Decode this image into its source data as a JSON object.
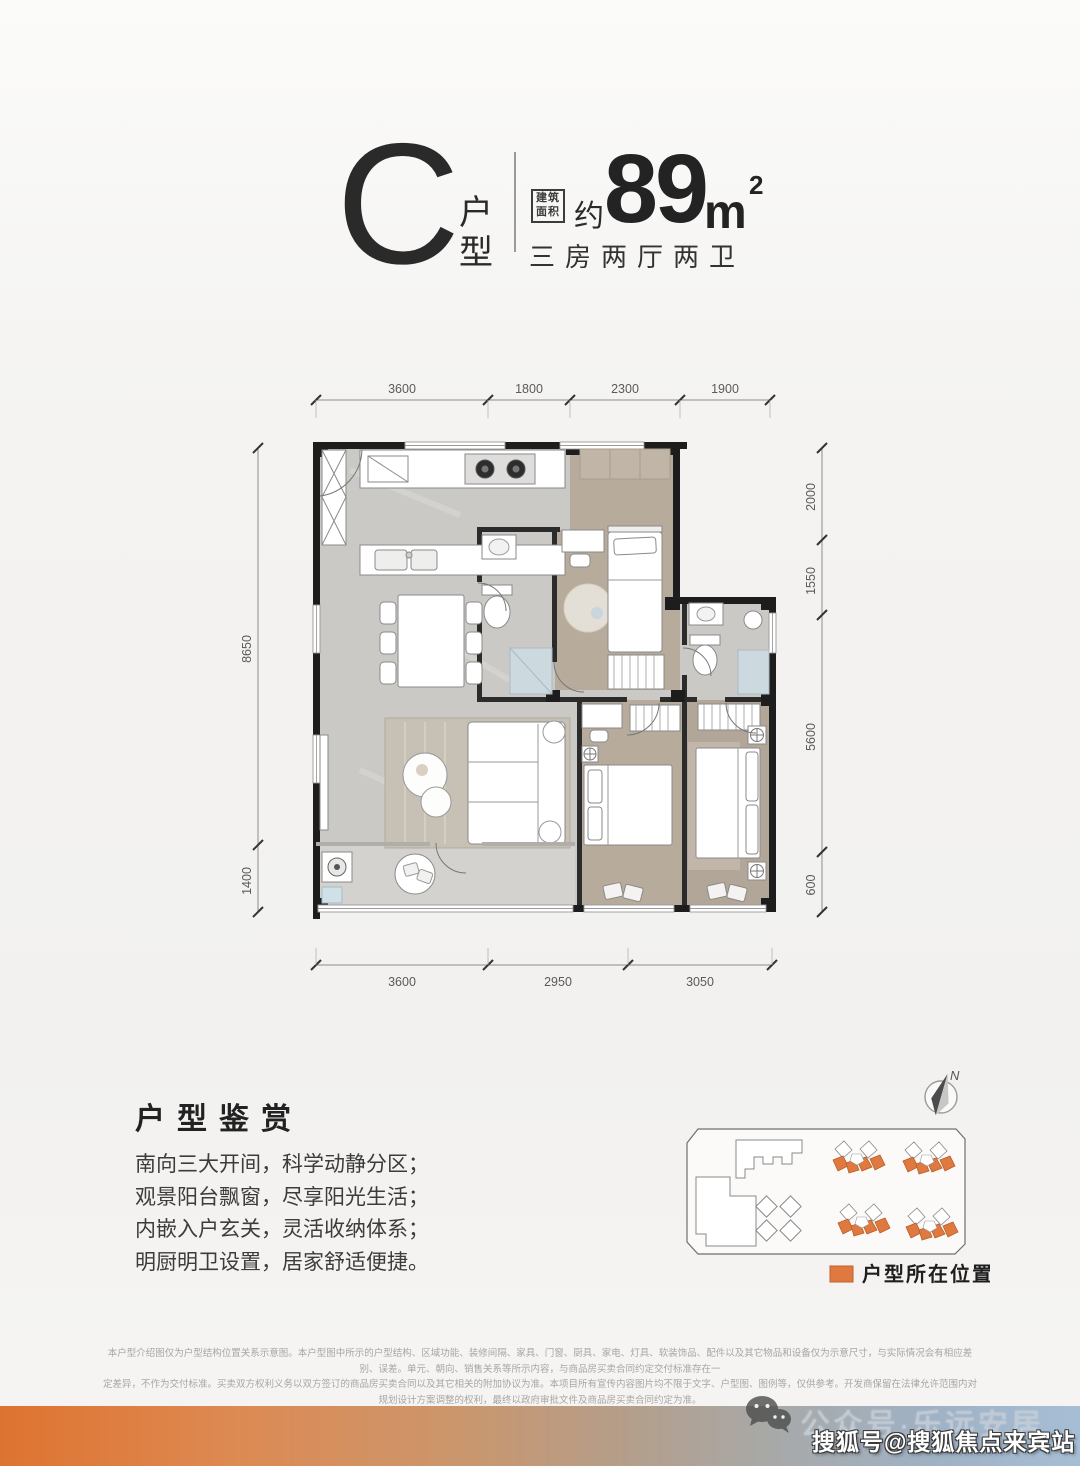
{
  "header": {
    "unit_letter": "C",
    "unit_type_char1": "户",
    "unit_type_char2": "型",
    "stamp_line1": "建筑",
    "stamp_line2": "面积",
    "approx": "约",
    "area_value": "89",
    "area_unit": "m",
    "area_sup": "2",
    "rooms": "三房两厅两卫"
  },
  "floorplan": {
    "dims_top": [
      "3600",
      "1800",
      "2300",
      "1900"
    ],
    "dims_bottom": [
      "3600",
      "2950",
      "3050"
    ],
    "dims_left": [
      "8650",
      "1400"
    ],
    "dims_right": [
      "2000",
      "1550",
      "5600",
      "600"
    ]
  },
  "appreciation": {
    "title": "户型鉴赏",
    "line1": "南向三大开间，科学动静分区；",
    "line2": "观景阳台飘窗，尽享阳光生活；",
    "line3": "内嵌入户玄关，灵活收纳体系；",
    "line4": "明厨明卫设置，居家舒适便捷。"
  },
  "siteplan": {
    "north_label": "N",
    "legend_label": "户型所在位置",
    "highlight_color": "#E0793F"
  },
  "disclaimer": {
    "line1": "本户型介绍图仅为户型结构位置关系示意图。本户型图中所示的户型结构、区域功能、装修间隔、家具、门窗、厨具、家电、灯具、软装饰品、配件以及其它物品和设备仅为示意尺寸，与实际情况会有相应差别、误差。单元、朝向、销售关系等所示内容，与商品房买卖合同约定交付标准存在一",
    "line2": "定差异，不作为交付标准。买卖双方权利义务以双方签订的商品房买卖合同以及其它相关的附加协议为准。本项目所有宣传内容图片均不限于文字、户型图、图例等，仅供参考。开发商保留在法律允许范围内对规划设计方案调整的权利，最终以政府审批文件及商品房买卖合同约定为准。",
    "line3": "本资料相关的服务参考咨询，具体成交须以内容、图片相关项目开发商为准，本资料制作时间2022年4月。"
  },
  "watermarks": {
    "wechat_label": "公众号·乐远安居",
    "sohu_label": "搜狐号@搜狐焦点来宾站"
  }
}
